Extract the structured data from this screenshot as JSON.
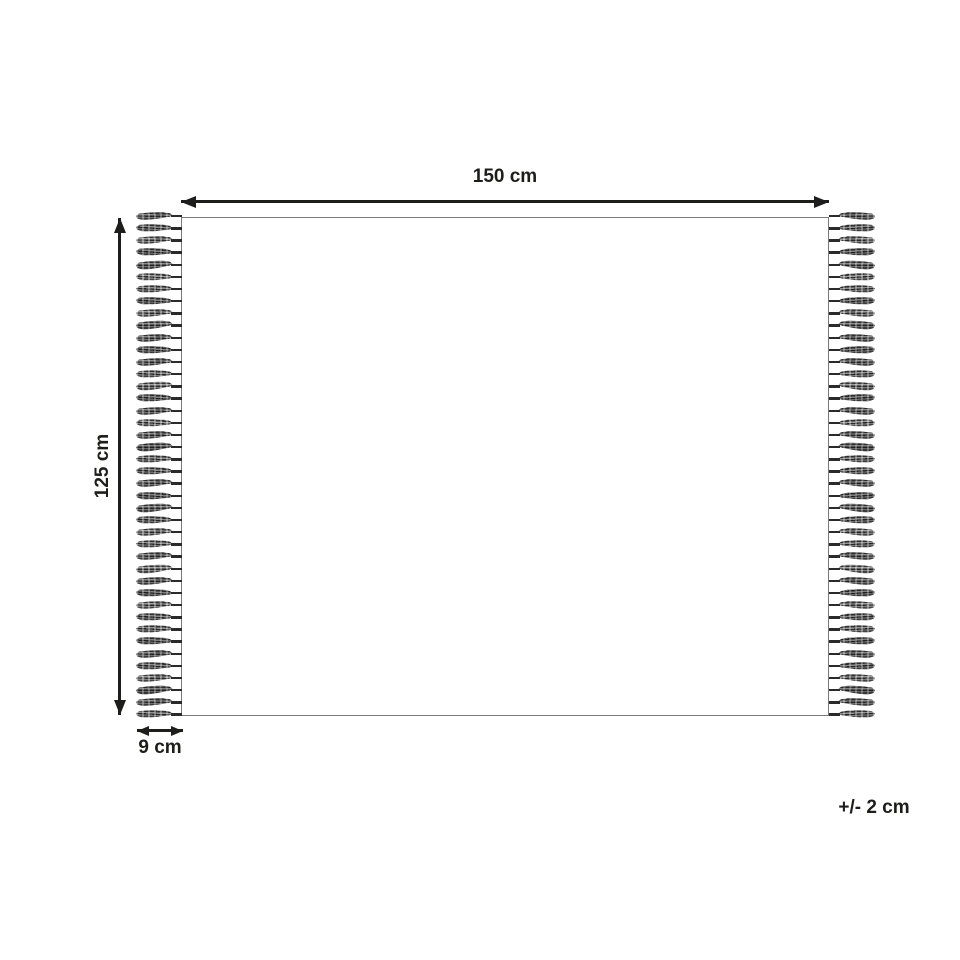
{
  "labels": {
    "width": "150 cm",
    "height": "125 cm",
    "fringe_width": "9 cm",
    "tolerance": "+/- 2 cm"
  },
  "rug": {
    "tassels_per_side": 42
  },
  "colors": {
    "ink": "#1d1d1b",
    "rug_border": "#7a7a7a",
    "background": "#ffffff"
  }
}
